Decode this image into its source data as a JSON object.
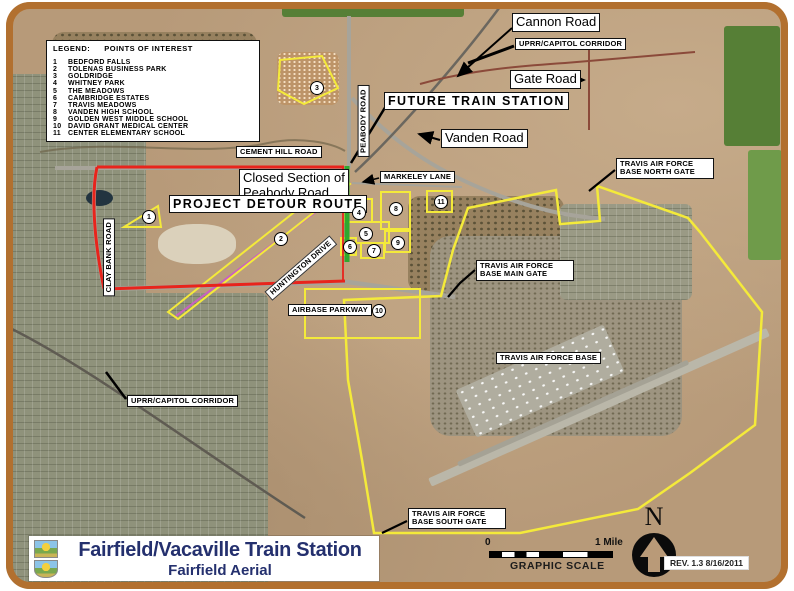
{
  "title_block": {
    "title": "Fairfield/Vacaville Train Station",
    "subtitle": "Fairfield Aerial"
  },
  "legend": {
    "heading_label": "LEGEND:",
    "heading_title": "POINTS OF INTEREST",
    "items": [
      {
        "num": "1",
        "label": "BEDFORD FALLS"
      },
      {
        "num": "2",
        "label": "TOLENAS BUSINESS PARK"
      },
      {
        "num": "3",
        "label": "GOLDRIDGE"
      },
      {
        "num": "4",
        "label": "WHITNEY PARK"
      },
      {
        "num": "5",
        "label": "THE MEADOWS"
      },
      {
        "num": "6",
        "label": "CAMBRIDGE ESTATES"
      },
      {
        "num": "7",
        "label": "TRAVIS MEADOWS"
      },
      {
        "num": "8",
        "label": "VANDEN HIGH SCHOOL"
      },
      {
        "num": "9",
        "label": "GOLDEN WEST MIDDLE SCHOOL"
      },
      {
        "num": "10",
        "label": "DAVID GRANT MEDICAL CENTER"
      },
      {
        "num": "11",
        "label": "CENTER ELEMENTARY SCHOOL"
      }
    ]
  },
  "labels": {
    "cannon_road": "Cannon Road",
    "uprr_capitol_corridor_top": "UPRR/CAPITOL CORRIDOR",
    "gate_road": "Gate Road",
    "future_train_station": "FUTURE TRAIN STATION",
    "vanden_road": "Vanden Road",
    "cement_hill_road": "CEMENT HILL ROAD",
    "closed_section": "Closed Section of Peabody Road",
    "project_detour_route": "PROJECT DETOUR ROUTE",
    "markeley_lane": "MARKELEY LANE",
    "peabody_road": "PEABODY ROAD",
    "clay_bank_road": "CLAY BANK ROAD",
    "huntington_drive": "HUNTINGTON DRIVE",
    "airbase_parkway": "AIRBASE PARKWAY",
    "tafb_north_gate": "TRAVIS AIR FORCE BASE NORTH GATE",
    "tafb_main_gate": "TRAVIS AIR FORCE BASE MAIN GATE",
    "travis_afb": "TRAVIS AIR FORCE BASE",
    "tafb_south_gate": "TRAVIS AIR FORCE BASE SOUTH GATE",
    "uprr_capitol_corridor_bottom": "UPRR/CAPITOL CORRIDOR"
  },
  "poi_markers": [
    {
      "num": "1"
    },
    {
      "num": "2"
    },
    {
      "num": "3"
    },
    {
      "num": "4"
    },
    {
      "num": "5"
    },
    {
      "num": "6"
    },
    {
      "num": "7"
    },
    {
      "num": "8"
    },
    {
      "num": "9"
    },
    {
      "num": "10"
    },
    {
      "num": "11"
    }
  ],
  "scale_bar": {
    "start": "0",
    "end": "1 Mile",
    "caption": "GRAPHIC SCALE"
  },
  "north_arrow": {
    "label": "N"
  },
  "revision": {
    "text": "REV.  1.3     8/16/2011"
  },
  "colors": {
    "frame": "#b2702f",
    "detour_route_red": "#e8241c",
    "closed_section_green": "#2fa82f",
    "afb_boundary_yellow": "#f4ea3a",
    "rail_magenta": "#c95fc2",
    "title_navy": "#24306e"
  }
}
